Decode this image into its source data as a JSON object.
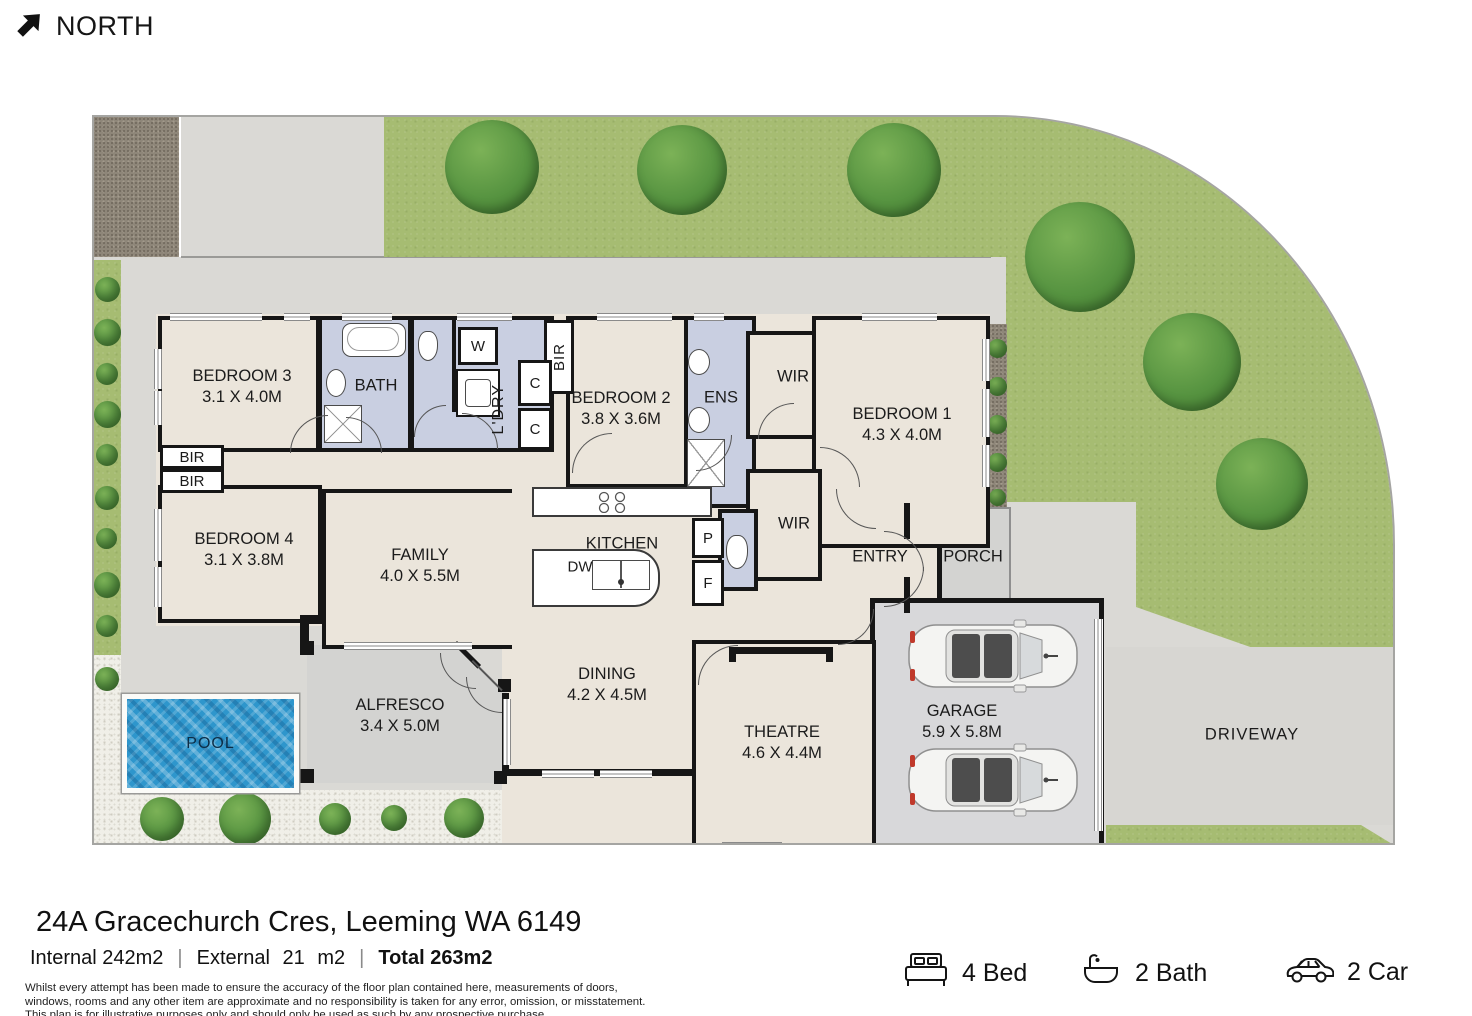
{
  "meta": {
    "north": "NORTH"
  },
  "plan": {
    "labels": {
      "bedroom1": {
        "name": "BEDROOM 1",
        "dims": "4.3 X 4.0M"
      },
      "bedroom2": {
        "name": "BEDROOM 2",
        "dims": "3.8 X 3.6M"
      },
      "bedroom3": {
        "name": "BEDROOM 3",
        "dims": "3.1 X 4.0M"
      },
      "bedroom4": {
        "name": "BEDROOM 4",
        "dims": "3.1 X 3.8M"
      },
      "family": {
        "name": "FAMILY",
        "dims": "4.0 X 5.5M"
      },
      "dining": {
        "name": "DINING",
        "dims": "4.2 X 4.5M"
      },
      "theatre": {
        "name": "THEATRE",
        "dims": "4.6 X 4.4M"
      },
      "alfresco": {
        "name": "ALFRESCO",
        "dims": "3.4 X 5.0M"
      },
      "garage": {
        "name": "GARAGE",
        "dims": "5.9 X 5.8M"
      },
      "kitchen": "KITCHEN",
      "bath": "BATH",
      "ens": "ENS",
      "laundry": "L'DRY",
      "entry": "ENTRY",
      "porch": "PORCH",
      "pool": "POOL",
      "driveway": "DRIVEWAY",
      "wir_top": "WIR",
      "wir_bottom": "WIR",
      "bir_bed2": "BIR",
      "bir_top": "BIR",
      "bir_bottom": "BIR",
      "washer": "W",
      "cupboard1": "C",
      "cupboard2": "C",
      "pantry": "P",
      "fridge": "F",
      "dishwasher": "DW"
    }
  },
  "footer": {
    "address": "24A Gracechurch Cres, Leeming WA 6149",
    "internal": "Internal 242m2",
    "external": "External 21 m2",
    "total": "Total 263m2",
    "separator": "|",
    "disclaimer_line1": "Whilst every attempt has been made to ensure the accuracy of the floor plan contained here, measurements of doors,",
    "disclaimer_line2": "windows, rooms and any other item are approximate and no responsibility is taken for any error, omission, or misstatement.",
    "disclaimer_line3": "This plan is for illustrative purposes only and should only be used as such by any prospective purchase",
    "stats": [
      {
        "icon": "bed-icon",
        "label": "4 Bed"
      },
      {
        "icon": "bath-icon",
        "label": "2 Bath"
      },
      {
        "icon": "car-icon",
        "label": "2 Car"
      }
    ]
  },
  "colors": {
    "wall": "#161616",
    "interior": "#EBE5DB",
    "wet_area": "#C9CFE1",
    "outdoor_paved": "#D3D3D1",
    "grass": "#A6BC72",
    "pool_water": "#2E96CC"
  }
}
